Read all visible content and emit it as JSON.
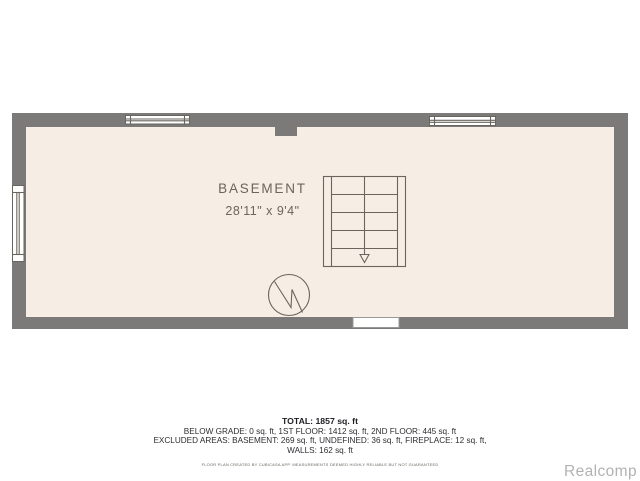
{
  "plan": {
    "room_label": "BASEMENT",
    "room_dimensions": "28'11\" x 9'4\""
  },
  "summary": {
    "total": "TOTAL: 1857 sq. ft",
    "floors_line": "BELOW GRADE: 0 sq. ft, 1ST FLOOR: 1412 sq. ft, 2ND FLOOR: 445 sq. ft",
    "excluded_line": "EXCLUDED AREAS: BASEMENT: 269 sq. ft, UNDEFINED: 36 sq. ft, FIREPLACE: 12 sq. ft,",
    "walls_line": "WALLS: 162 sq. ft",
    "disclaimer": "FLOOR PLAN CREATED BY CUBICASA APP. MEASUREMENTS DEEMED HIGHLY RELIABLE BUT NOT GUARANTEED"
  },
  "watermark": {
    "label": "Realcomp"
  },
  "colors": {
    "wall": "#7c7a78",
    "floor": "#f6ede4",
    "line": "#6a655e",
    "room_text": "#6b655c",
    "text_dark": "#2e2e33",
    "watermark": "#b4b2b0"
  }
}
